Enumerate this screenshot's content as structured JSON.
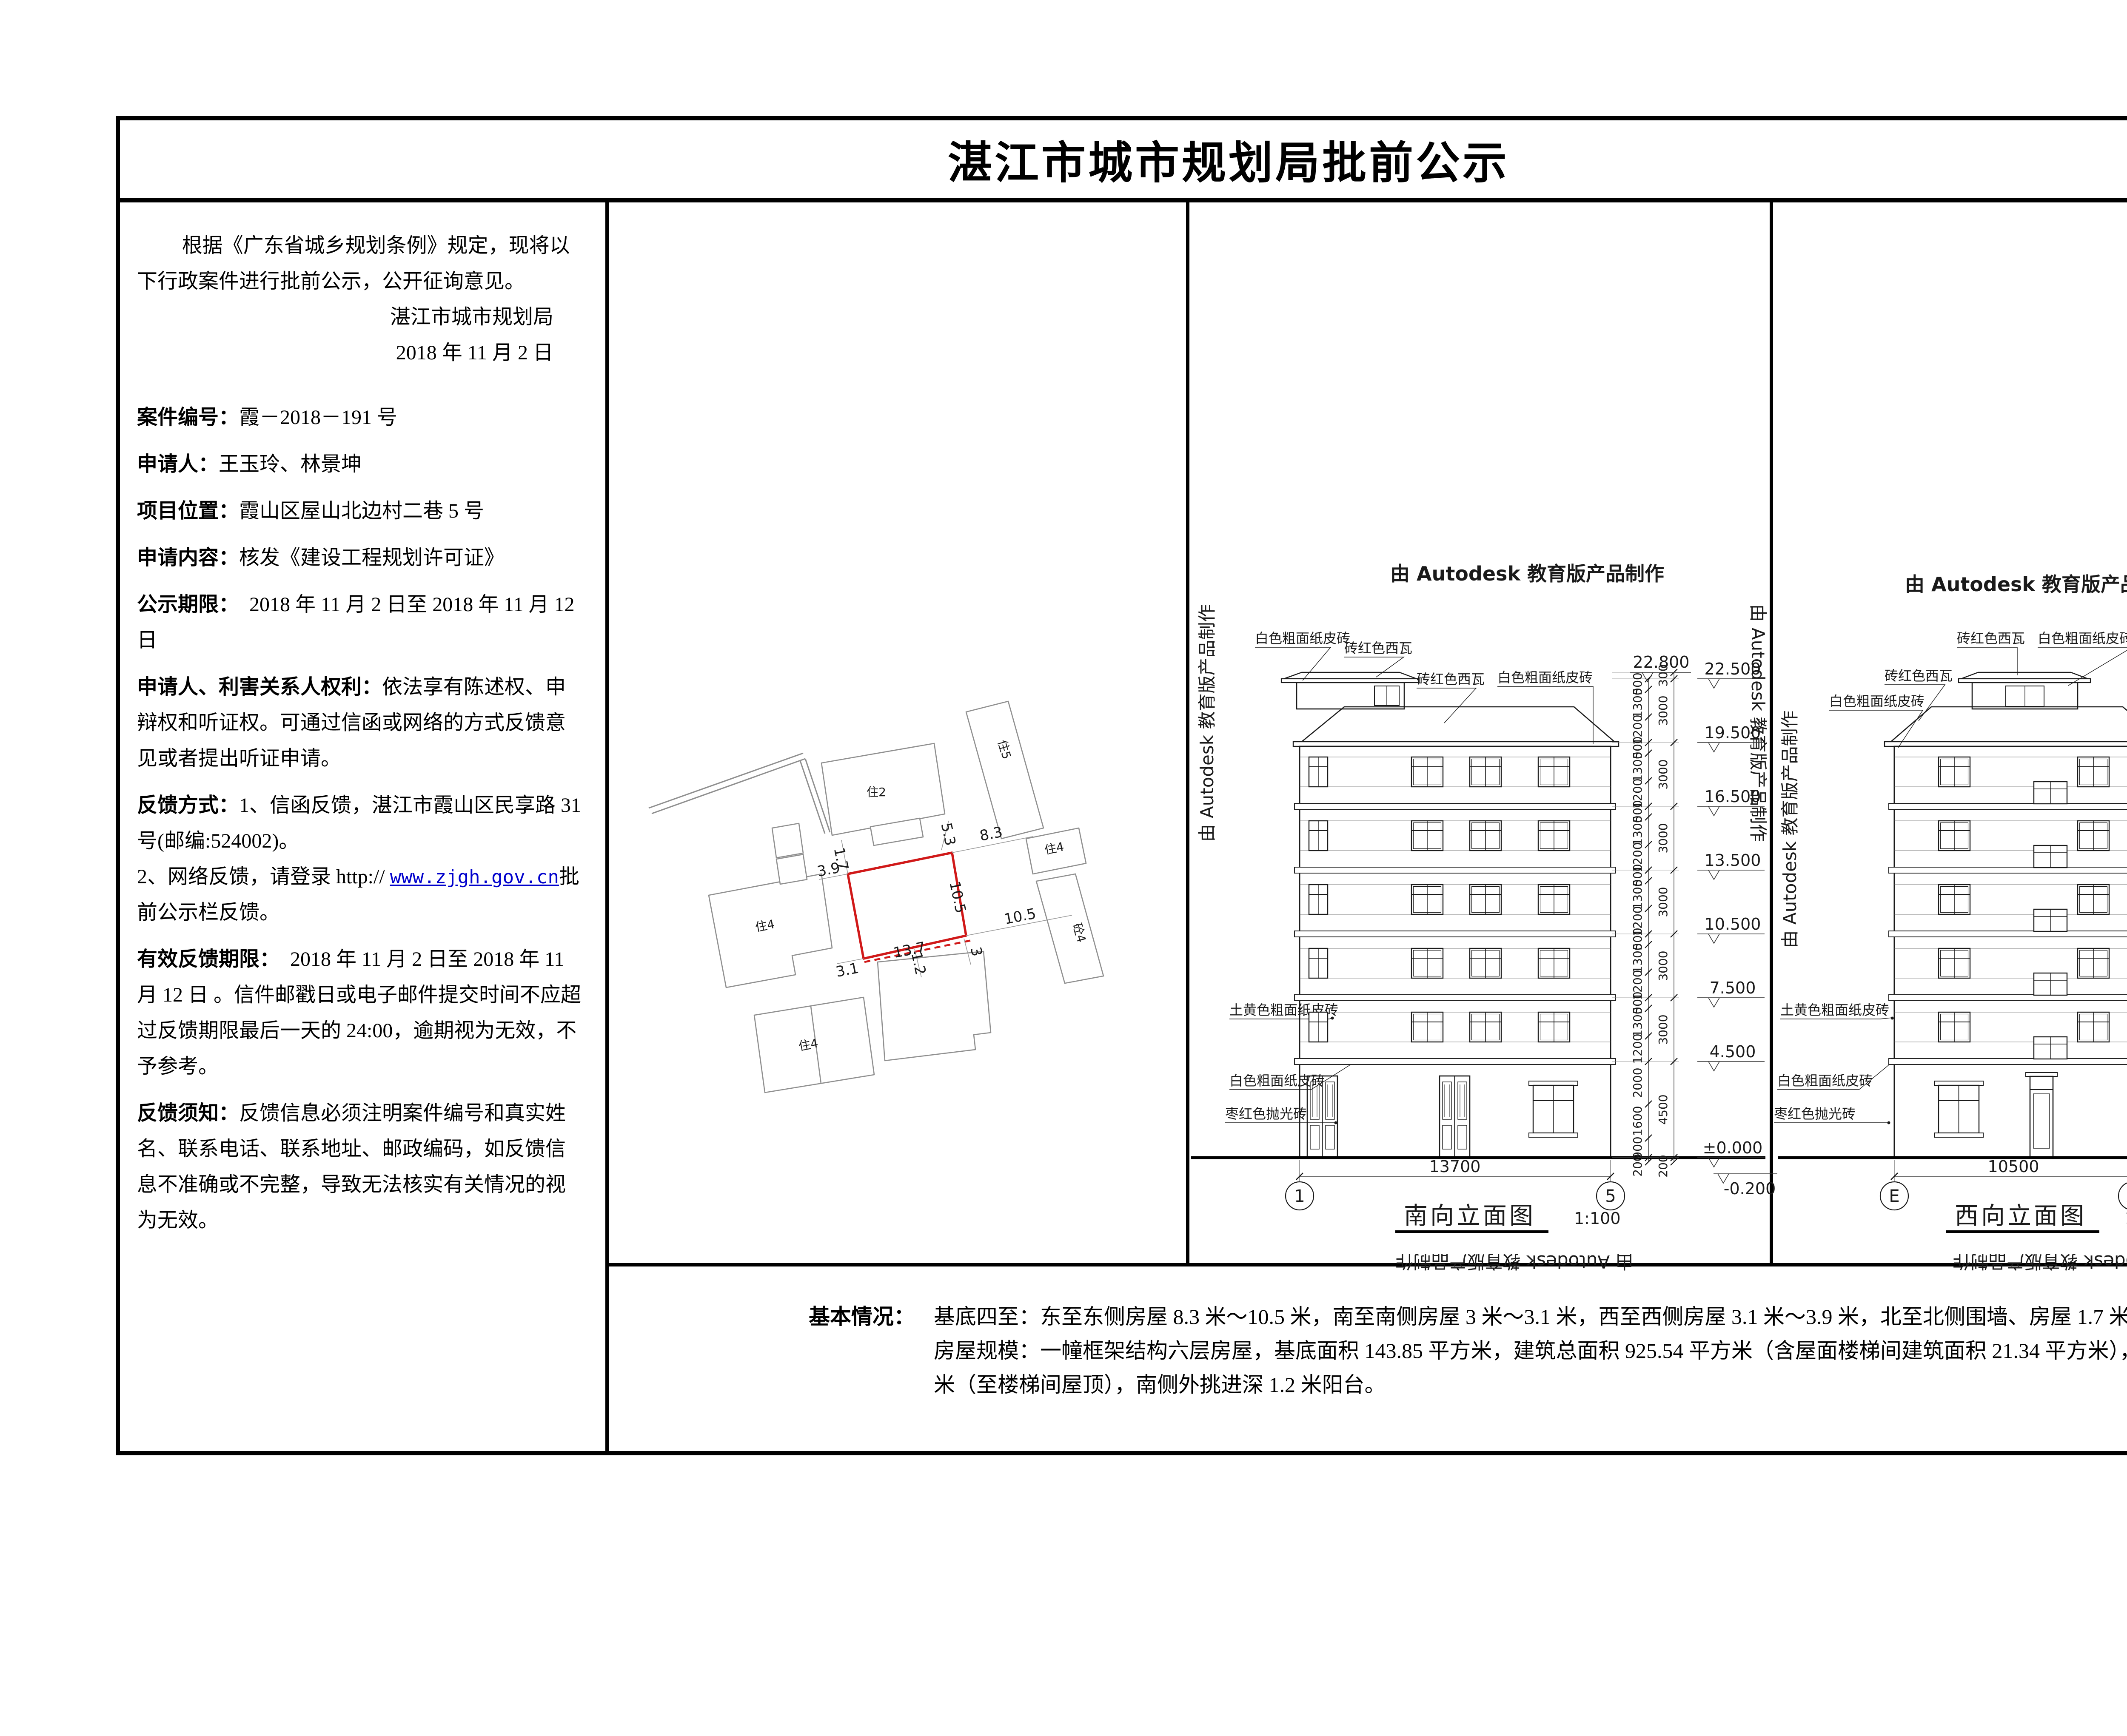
{
  "title": "湛江市城市规划局批前公示",
  "notice": {
    "p1": "根据《广东省城乡规划条例》规定，现将以下行政案件进行批前公示，公开征询意见。",
    "sign_org": "湛江市城市规划局",
    "sign_date": "2018 年 11 月 2 日",
    "items": [
      {
        "label": "案件编号：",
        "text": "霞－2018－191 号"
      },
      {
        "label": "申请人：",
        "text": "王玉玲、林景坤"
      },
      {
        "label": "项目位置：",
        "text": "霞山区屋山北边村二巷 5 号"
      },
      {
        "label": "申请内容：",
        "text": "核发《建设工程规划许可证》"
      },
      {
        "label": "公示期限：",
        "text": "　2018 年 11 月 2 日至 2018 年 11 月 12 日"
      },
      {
        "label": "申请人、利害关系人权利：",
        "text": "依法享有陈述权、申辩权和听证权。可通过信函或网络的方式反馈意见或者提出听证申请。"
      },
      {
        "label": "反馈方式：",
        "text": "1、信函反馈，湛江市霞山区民享路 31 号(邮编:524002)。"
      }
    ],
    "web_prefix": "2、网络反馈，请登录 http:// ",
    "web_link": "www.zjgh.gov.cn",
    "web_suffix": "批前公示栏反馈。",
    "item_valid": {
      "label": "有效反馈期限：",
      "text": "　2018 年 11 月 2 日至 2018 年 11 月 12 日 。信件邮戳日或电子邮件提交时间不应超过反馈期限最后一天的 24:00，逾期视为无效，不予参考。"
    },
    "item_note": {
      "label": "反馈须知：",
      "text": "反馈信息必须注明案件编号和真实姓名、联系电话、联系地址、邮政编码，如反馈信息不准确或不完整，导致无法核实有关情况的视为无效。"
    }
  },
  "info": {
    "label": "基本情况：",
    "line1": "基底四至：东至东侧房屋 8.3 米～10.5 米，南至南侧房屋 3 米～3.1 米，西至西侧房屋 3.1 米～3.9 米，北至北侧围墙、房屋 1.7 米～5.3 米。",
    "line2": "房屋规模：一幢框架结构六层房屋，基底面积 143.85 平方米，建筑总面积 925.54 平方米（含屋面楼梯间建筑面积 21.34 平方米），房屋总高度 22.8 米（至楼梯间屋顶），南侧外挑进深 1.2 米阳台。"
  },
  "autodesk": "由 Autodesk 教育版产品制作",
  "siteplan": {
    "plot_dims": [
      "13.7",
      "10.5"
    ],
    "setbacks": [
      "1.7",
      "5.3",
      "8.3",
      "3.9",
      "3.1",
      "10.5",
      "1.2",
      "3"
    ],
    "buildings": [
      "住2",
      "住5",
      "住4",
      "砼4",
      "住4",
      "住4"
    ],
    "plot_color": "#d01818"
  },
  "south": {
    "title": "南向立面图",
    "scale": "1:100",
    "axis_left": "1",
    "axis_right": "5",
    "width_dim": "13700",
    "levels": [
      "22.800",
      "22.500",
      "19.500",
      "16.500",
      "13.500",
      "10.500",
      "7.500",
      "4.500",
      "±0.000",
      "-0.200"
    ],
    "floor_dims": [
      "500",
      "1300",
      "1200"
    ],
    "ground_dims": [
      "2000",
      "1600",
      "900",
      "200"
    ],
    "outer_dims": [
      "300",
      "3000",
      "4500",
      "200"
    ],
    "materials": [
      "白色粗面纸皮砖",
      "砖红色西瓦",
      "砖红色西瓦",
      "白色粗面纸皮砖",
      "土黄色粗面纸皮砖",
      "白色粗面纸皮砖",
      "枣红色抛光砖"
    ]
  },
  "west": {
    "title": "西向立面图",
    "scale": "1:100",
    "axis_left": "E",
    "axis_right": "A",
    "width_dim": "10500",
    "balcony_dim": "1200",
    "levels": [
      "22.800",
      "22.500",
      "19.500",
      "16.500",
      "13.500",
      "10.500",
      "7.500",
      "4.500",
      "±0.000",
      "-0.200"
    ],
    "floor_dims": [
      "500",
      "1600",
      "900"
    ],
    "ground_dims": [
      "2000",
      "1600",
      "900",
      "200"
    ],
    "outer_dims": [
      "300",
      "3000",
      "4500",
      "200"
    ],
    "materials": [
      "砖红色西瓦",
      "白色粗面纸皮砖",
      "砖红色西瓦",
      "白色粗面纸皮砖",
      "土黄色粗面纸皮砖",
      "白色粗面纸皮砖",
      "枣红色抛光砖"
    ]
  }
}
